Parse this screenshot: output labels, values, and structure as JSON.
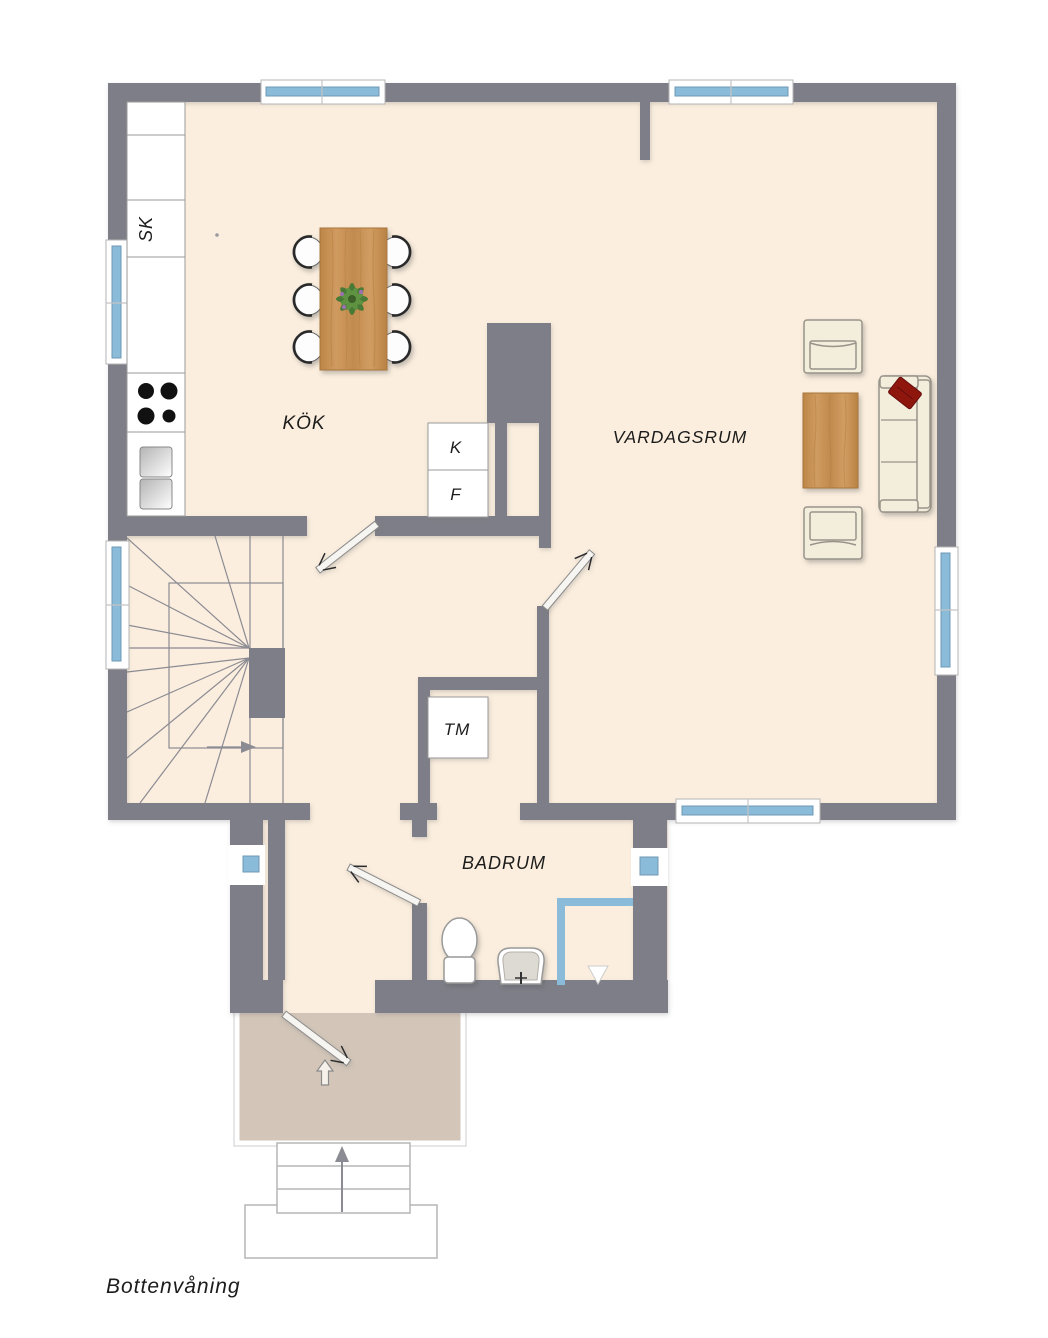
{
  "plan": {
    "title": "Bottenvåning",
    "rooms": {
      "kitchen": "KÖK",
      "living_room": "VARDAGSRUM",
      "bathroom": "BADRUM"
    },
    "labels": {
      "cabinet": "SK",
      "fridge": "K",
      "freezer": "F",
      "washing_machine": "TM"
    },
    "colors": {
      "wall": "#7e7e88",
      "floor": "#fbeede",
      "porch": "#d3c6b9",
      "window": "#8abbd8",
      "wood": "#c8945c",
      "pillow": "#8e150f"
    }
  }
}
